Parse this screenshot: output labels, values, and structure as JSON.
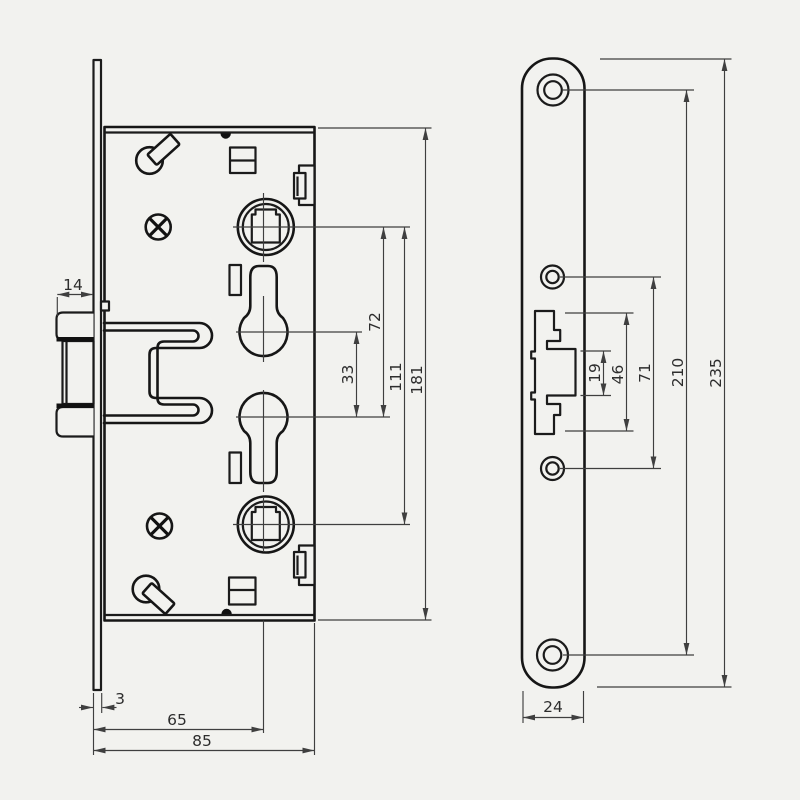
{
  "colors": {
    "paper": "#f2f2ef",
    "ink": "#161616",
    "dim_line": "#3f3f3f",
    "dim_text": "#2d2d2d"
  },
  "dims": {
    "latch_protrusion": "14",
    "faceplate_thickness": "3",
    "backset": "65",
    "case_depth": "85",
    "cylinder_spacing": "33",
    "follower_to_cylinder": "72",
    "follower_spacing": "111",
    "case_height": "181",
    "cutout_slot_height": "19",
    "cutout_height": "46",
    "screw_spacing_inner": "71",
    "screw_spacing_outer": "210",
    "plate_height": "235",
    "plate_width": "24"
  }
}
